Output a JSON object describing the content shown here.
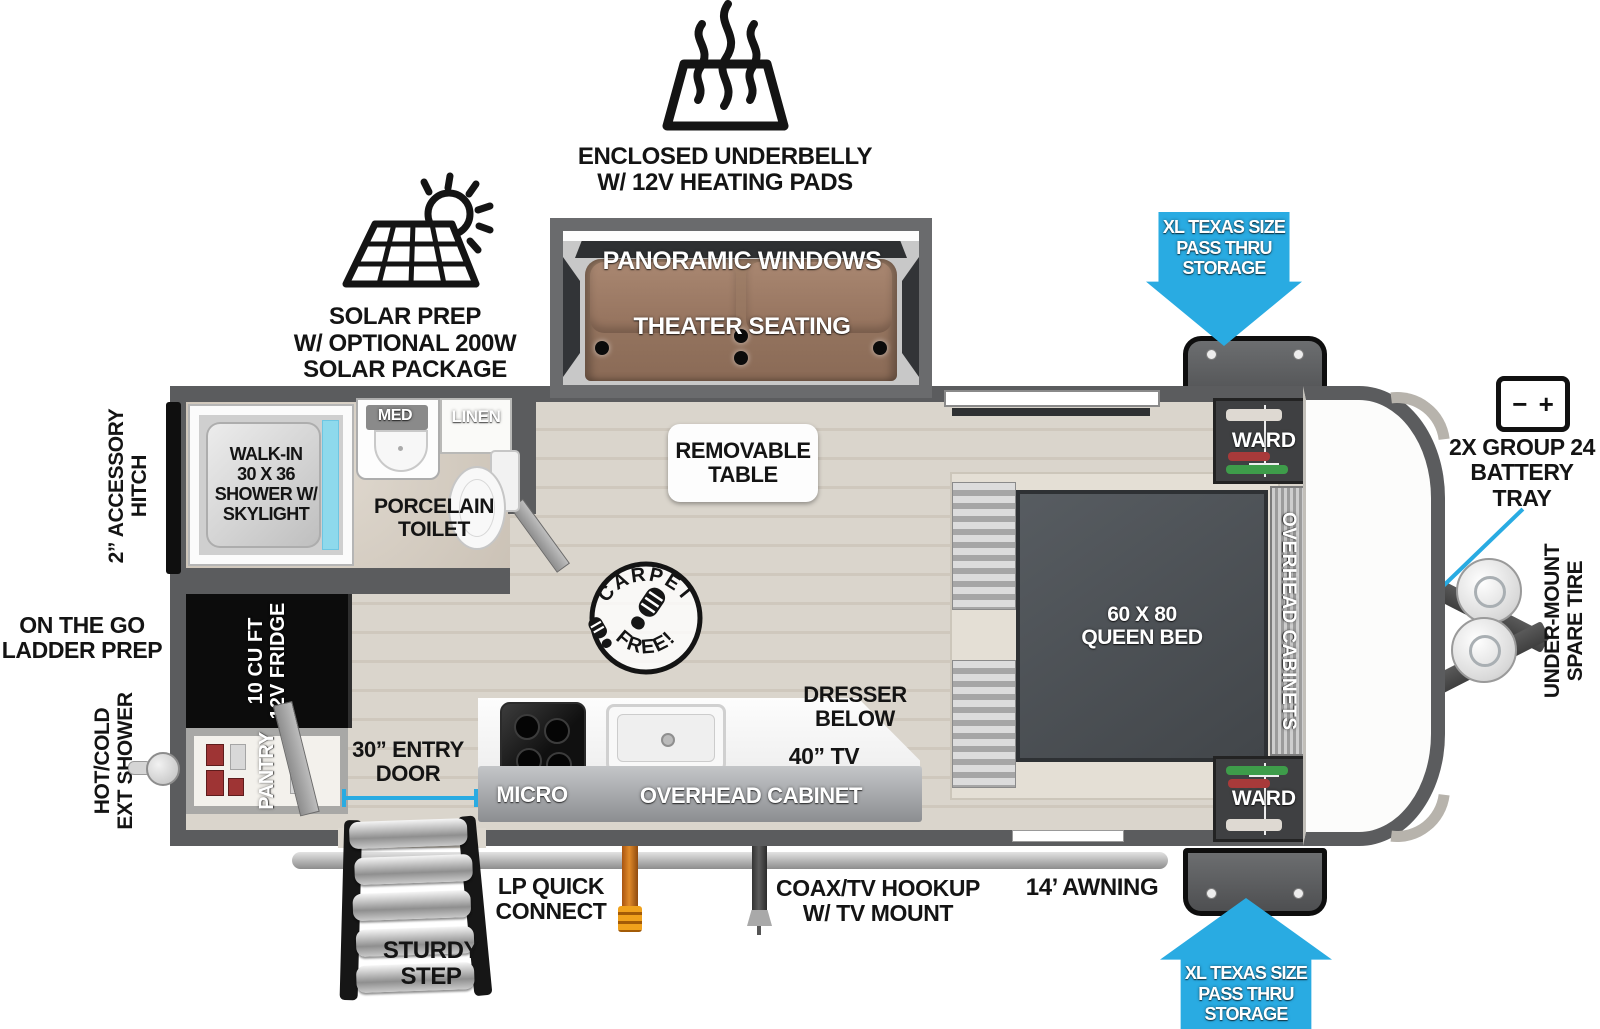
{
  "colors": {
    "accent_blue": "#29ABE2",
    "wall_gray": "#5B5C5E",
    "floor_beige": "#D8D2C7",
    "couch_brown": "#96755F",
    "bed_gray": "#4C5054",
    "shower_glass": "#7DDBF2",
    "lp_orange": "#D97A1A"
  },
  "exterior": {
    "underbelly": "ENCLOSED UNDERBELLY\nW/ 12V HEATING PADS",
    "solar": "SOLAR PREP\nW/ OPTIONAL 200W\nSOLAR PACKAGE",
    "pass_thru_top": "XL TEXAS SIZE\nPASS THRU\nSTORAGE",
    "pass_thru_bottom": "XL TEXAS SIZE\nPASS THRU\nSTORAGE",
    "battery": "2X GROUP 24\nBATTERY TRAY",
    "battery_icon_minus": "−",
    "battery_icon_plus": "+",
    "spare_tire": "UNDER-MOUNT\nSPARE TIRE",
    "accessory_hitch": "2” ACCESSORY\nHITCH",
    "ladder_prep": "ON THE GO\nLADDER PREP",
    "ext_shower": "HOT/COLD\nEXT SHOWER",
    "sturdy_step": "STURDY\nSTEP",
    "lp_connect": "LP QUICK\nCONNECT",
    "coax": "COAX/TV HOOKUP\nW/ TV MOUNT",
    "awning": "14’ AWNING",
    "entry_door": "30” ENTRY\nDOOR"
  },
  "interior": {
    "panoramic_windows": "PANORAMIC WINDOWS",
    "theater_seating": "THEATER SEATING",
    "removable_table": "REMOVABLE\nTABLE",
    "carpet_top": "CARPET",
    "carpet_bottom": "FREE!",
    "queen_bed": "60 X 80\nQUEEN BED",
    "overhead_cabinets": "OVERHEAD CABINETS",
    "ward_top": "WARD",
    "ward_bottom": "WARD",
    "dresser": "DRESSER\nBELOW",
    "tv": "40” TV",
    "micro": "MICRO",
    "overhead_cabinet": "OVERHEAD CABINET",
    "shower": "WALK-IN\n30 X 36\nSHOWER W/\nSKYLIGHT",
    "med": "MED",
    "linen": "LINEN",
    "toilet": "PORCELAIN\nTOILET",
    "fridge": "10 CU FT\n12V FRIDGE",
    "pantry": "PANTRY"
  }
}
